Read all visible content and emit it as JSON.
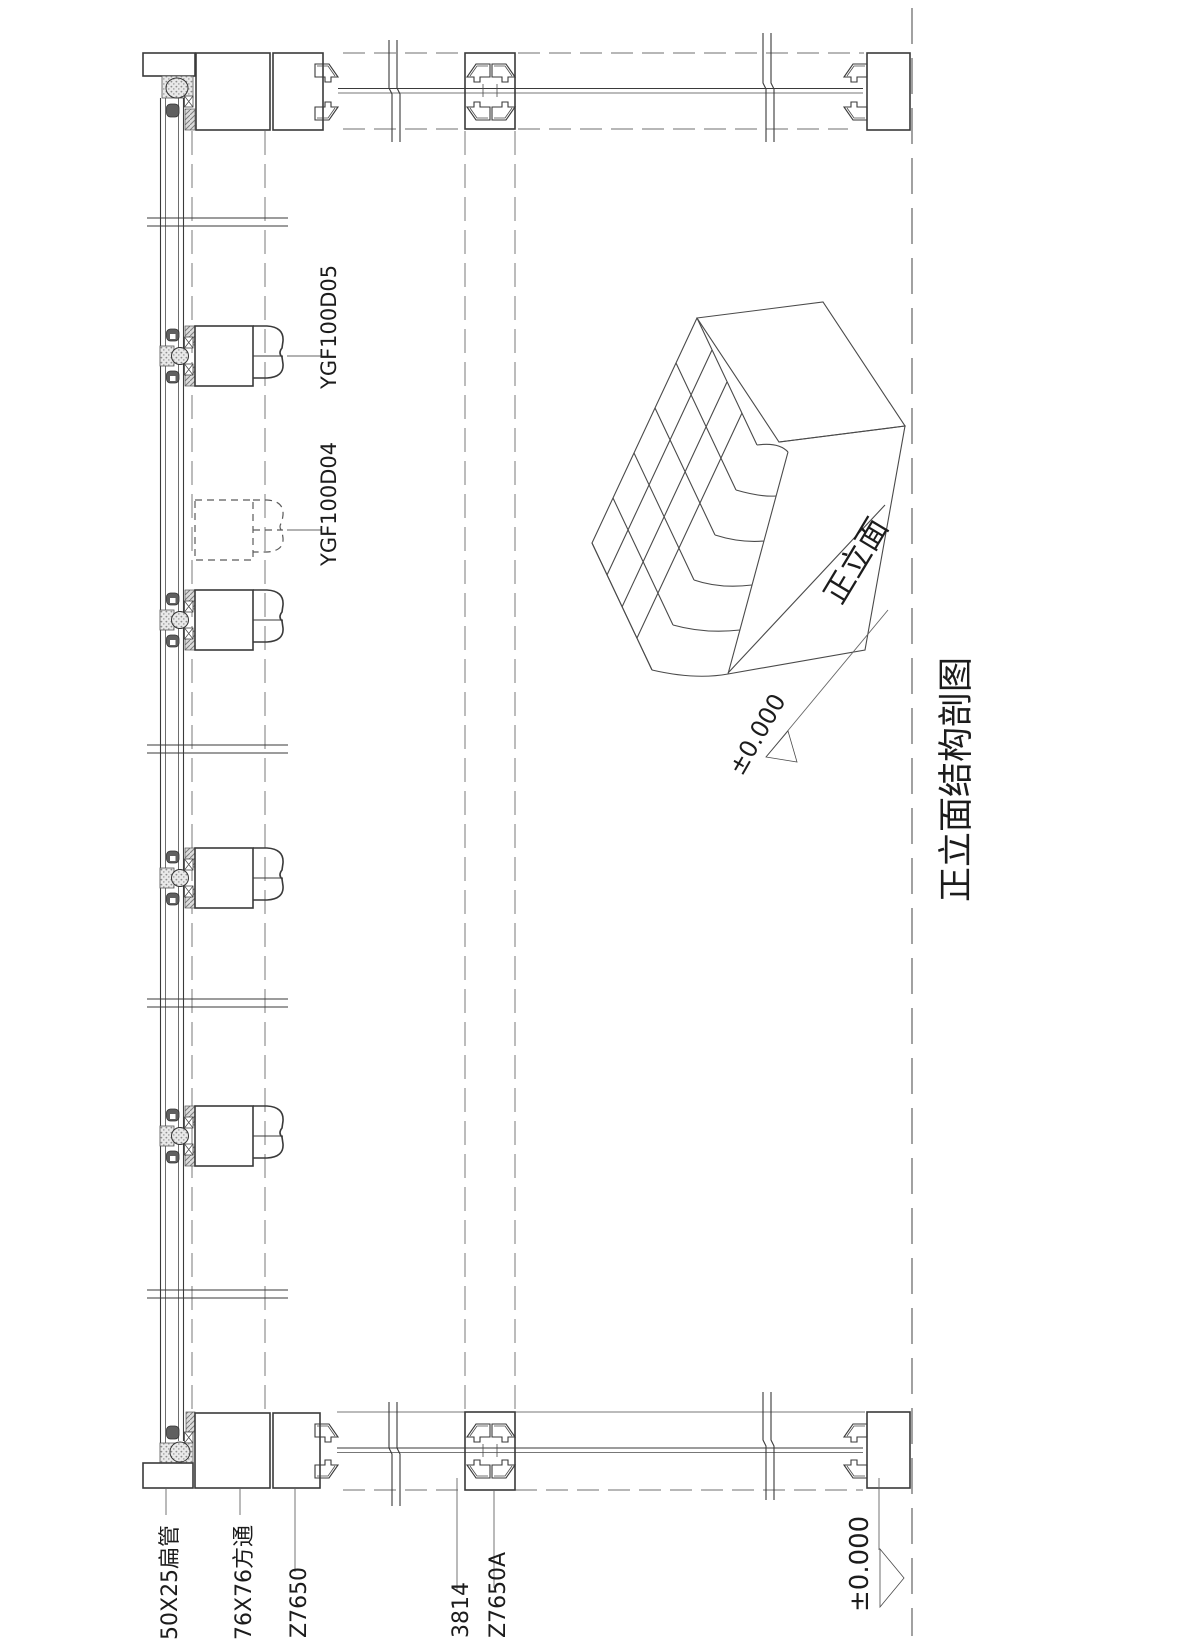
{
  "title": "正立面结构剖图",
  "labels": {
    "profile_top": "YGF100D05",
    "profile_ghost": "YGF100D04",
    "flat_tube": "50X25扁管",
    "square_tube": "76X76方通",
    "left_profile": "Z7650",
    "dim": "3814",
    "mid_profile": "Z7650A",
    "level_ground": "±0.000",
    "level_cube": "±0.000",
    "cube_face": "正立面"
  },
  "colors": {
    "line": "#3a3a3a",
    "dashed": "#7a7a7a",
    "background": "#ffffff"
  }
}
